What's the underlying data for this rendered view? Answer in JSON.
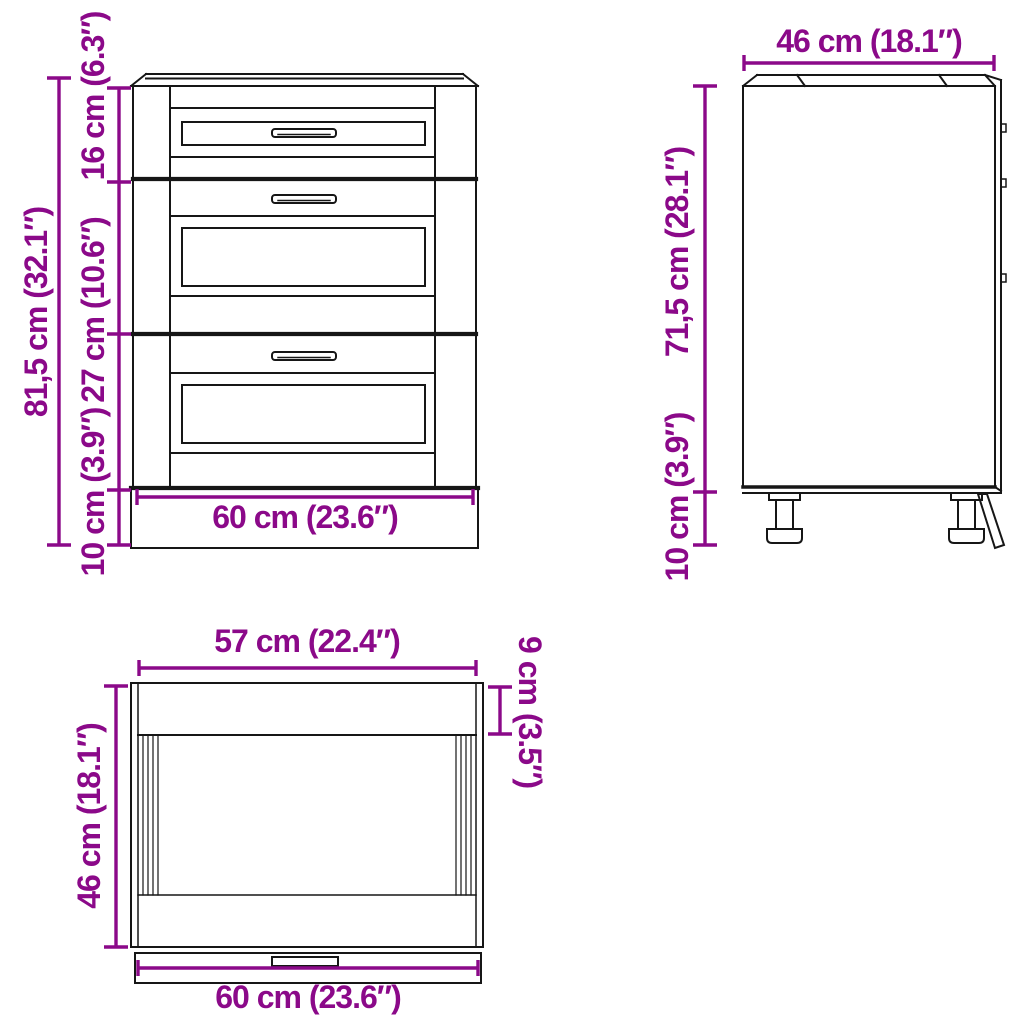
{
  "colors": {
    "dimension": "#8B0989",
    "line": "#161616",
    "background": "#ffffff"
  },
  "front_view": {
    "dimensions": {
      "total_height": "81,5 cm (32.1″)",
      "top_drawer_height": "16 cm (6.3″)",
      "middle_drawer_height": "27 cm (10.6″)",
      "plinth_height": "10 cm (3.9″)",
      "width": "60 cm (23.6″)"
    }
  },
  "side_view": {
    "dimensions": {
      "depth": "46 cm (18.1″)",
      "body_height": "71,5 cm (28.1″)",
      "feet_height": "10 cm (3.9″)"
    }
  },
  "top_view": {
    "dimensions": {
      "inner_width": "57 cm (22.4″)",
      "front_rail_depth": "9 cm (3.5″)",
      "depth": "46 cm (18.1″)",
      "width": "60 cm (23.6″)"
    }
  }
}
